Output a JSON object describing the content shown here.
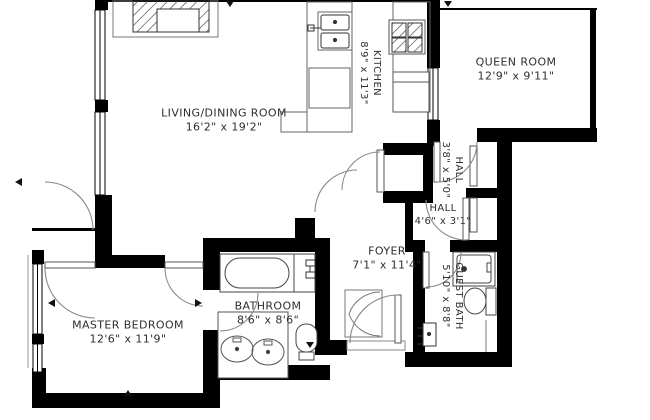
{
  "floorplan": {
    "background": "#ffffff",
    "wall_color": "#000000",
    "label_color": "#2e2e2e",
    "rooms": [
      {
        "name": "LIVING/DINING ROOM",
        "dims": "16'2\" x 19'2\""
      },
      {
        "name": "KITCHEN",
        "dims": "8'9\" x 11'3\""
      },
      {
        "name": "QUEEN ROOM",
        "dims": "12'9\" x 9'11\""
      },
      {
        "name": "HALL",
        "dims": "3'8\" x 5'0\""
      },
      {
        "name": "HALL",
        "dims": "4'6\" x 3'1\""
      },
      {
        "name": "FOYER",
        "dims": "7'1\" x 11'4\""
      },
      {
        "name": "GUEST BATH",
        "dims": "5'10\" x 8'8\""
      },
      {
        "name": "BATHROOM",
        "dims": "8'6\" x 8'6\""
      },
      {
        "name": "MASTER BEDROOM",
        "dims": "12'6\" x 11'9\""
      }
    ],
    "fixtures": [
      "fireplace",
      "kitchen-sink",
      "stove",
      "refrigerator",
      "kitchen-counters",
      "bathtub",
      "tub-faucet",
      "double-vanity-sinks",
      "toilet",
      "guest-toilet",
      "shower",
      "guest-sink",
      "entry-door",
      "bifold-closet-doors",
      "sliding-closet-doors",
      "windows"
    ]
  }
}
